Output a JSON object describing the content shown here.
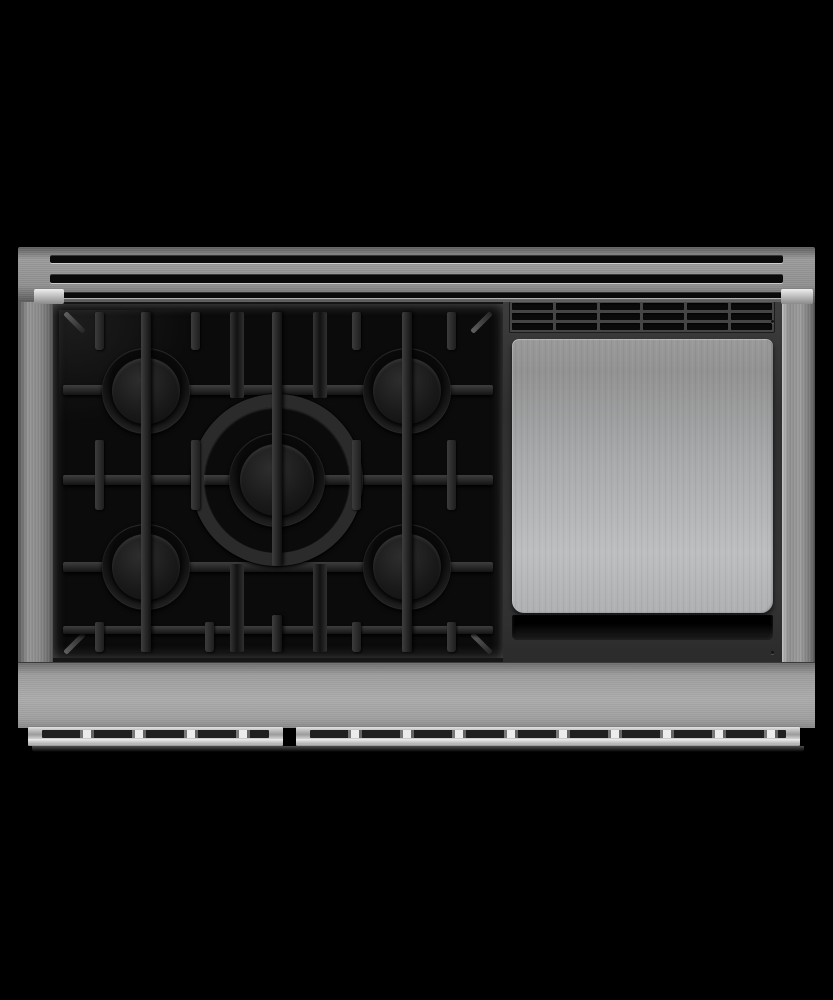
{
  "scene": {
    "type": "product-photo",
    "subject": "48-inch professional stainless-steel gas rangetop, viewed from directly above",
    "description": "Top-down product photograph of a stainless steel professional range cooktop on a black background: a rear vent strip with three slots, a black enameled five-burner gas cooktop with cast-iron grates and a central wok ring on the left, a brushed stainless griddle plate with a vented trim panel on the right, a stainless apron below, and two oven-door handle rails along the bottom edge.",
    "background_color": "#000000"
  },
  "colors": {
    "bg": "#000000",
    "steel": "#8f8f8f",
    "apron": "#acacac",
    "rail": "#d8d8d8",
    "glint": "#eeeeee",
    "ventSlot": "#0a0a0a",
    "cooktopBlack": "#0b0b0b",
    "grate": "#2d2d2d",
    "burnerCap": "#1a1a1a",
    "griddleFrame": "#333333",
    "griddlePlate": "#bcbec0",
    "trough": "#151515"
  },
  "parts": {
    "vent_strip": {
      "label": "rear vent strip",
      "slot_count": 3
    },
    "cooktop": {
      "label": "five-burner gas cooktop with cast-iron grates",
      "burner_count": 5,
      "burners": [
        "rear-left",
        "rear-right",
        "center-wok",
        "front-left",
        "front-right"
      ],
      "grate_sections": 3
    },
    "griddle": {
      "label": "stainless griddle plate with vented trim",
      "vent_rows": 3,
      "vent_columns": 6
    },
    "apron": {
      "label": "stainless front apron"
    },
    "handle_rails": {
      "label": "oven-door handle rails",
      "count": 2
    }
  }
}
